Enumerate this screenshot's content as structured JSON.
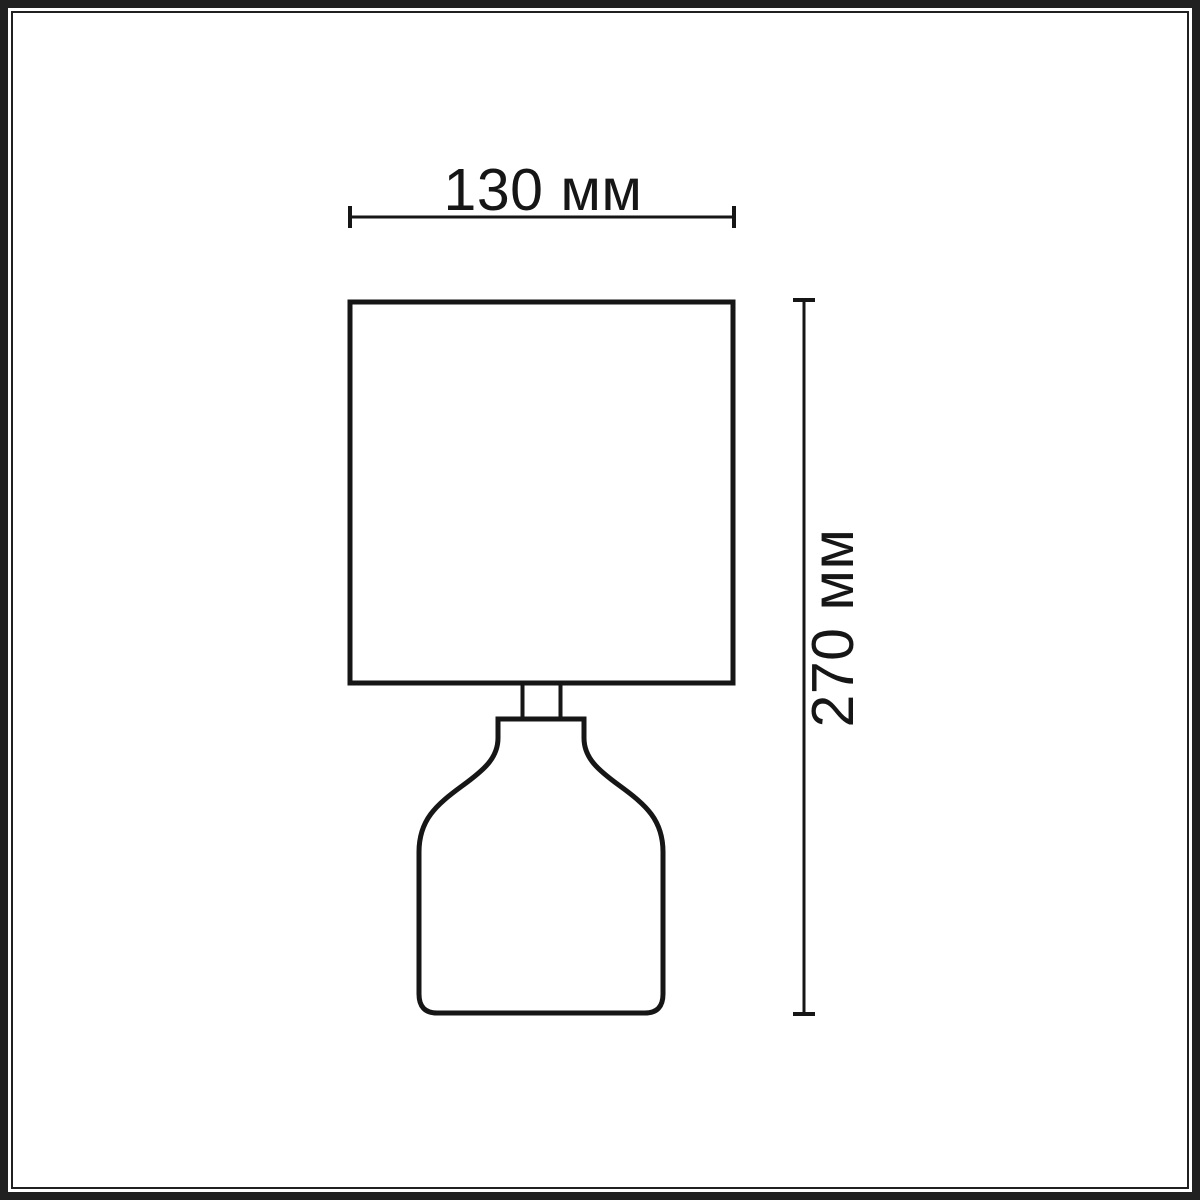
{
  "theme": {
    "background": "#ffffff",
    "frame_color": "#202020",
    "line_color": "#161616",
    "text_color": "#161616"
  },
  "drawing": {
    "object": "table-lamp-outline",
    "parts": [
      "shade",
      "neck",
      "base"
    ]
  },
  "dimensions": {
    "width": {
      "label": "130 мм",
      "value": 130,
      "unit": "мм"
    },
    "height": {
      "label": "270 мм",
      "value": 270,
      "unit": "мм"
    }
  }
}
